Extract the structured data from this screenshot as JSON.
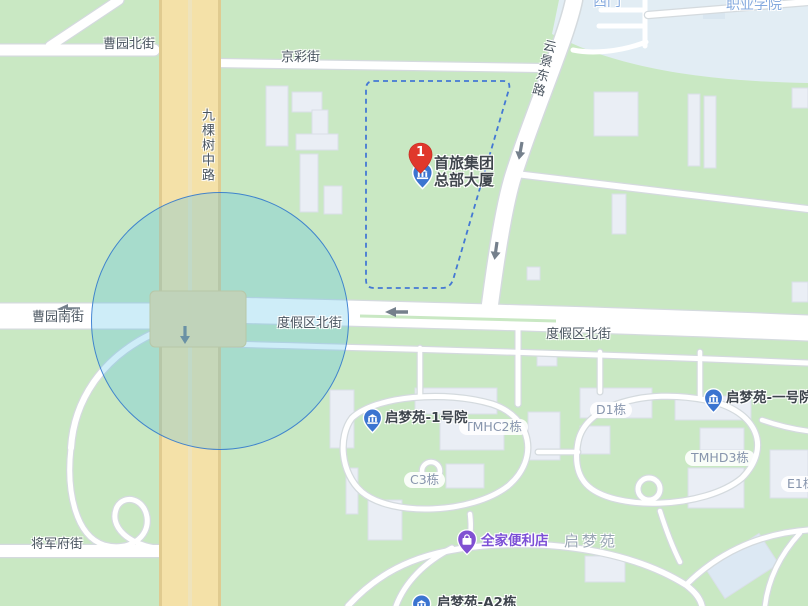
{
  "map": {
    "streets": {
      "caoyuan_north": "曹园北街",
      "jingcai": "京彩街",
      "jiukeshu_middle": "九棵树中路",
      "yunjing_east": "云景东路",
      "caoyuan_south": "曹园南街",
      "dujiaqu_north_west": "度假区北街",
      "dujiaqu_north_east": "度假区北街",
      "jiangjunfu": "将军府街"
    },
    "places": {
      "west_gate": "西门",
      "vocational_college": "职业学院",
      "qimengyuan_estate": "启梦苑"
    },
    "building_labels": {
      "tmhc2": "TMHC2栋",
      "c3": "C3栋",
      "d1": "D1栋",
      "tmhd3": "TMHD3栋",
      "e1": "E1栋"
    },
    "pois": {
      "result_marker": {
        "number": "1",
        "name_line1": "首旅集团",
        "name_line2": "总部大厦"
      },
      "qimengyuan_court1": "启梦苑-1号院",
      "qimengyuan_court_yihao": "启梦苑-一号院",
      "familymart": "全家便利店",
      "qimengyuan_a2": "启梦苑-A2栋"
    },
    "colors": {
      "land": "#c9e8c3",
      "campus_area": "#e2edf4",
      "major_road": "#f4e1a8",
      "minor_road": "#ffffff",
      "accuracy_circle_stroke": "#2d73cd",
      "selection_dash": "#4478d4",
      "result_marker_red": "#e0382c",
      "poi_pin_blue": "#3b74d0",
      "familymart_purple": "#8050d2"
    }
  }
}
